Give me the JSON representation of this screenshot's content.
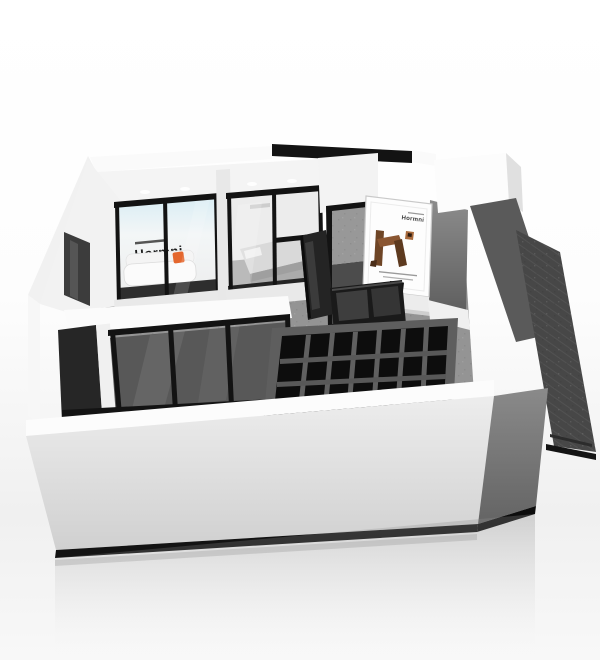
{
  "brand": "Hormni",
  "signs": {
    "sofa_room_wall_sign": "Hormni",
    "poster_logo": "Hormni"
  },
  "icons": {
    "qr_code": "▦"
  },
  "colors": {
    "background": "#ffffff",
    "wall_white": "#f8f8f8",
    "wall_shade": "#e2e2e2",
    "floor_gray": "#949494",
    "glass_dark": "#585858",
    "frame_black": "#131313",
    "dark_gray_wall": "#5a5a5a",
    "ramp_dark": "#474747",
    "front_wall_light": "#ededed",
    "front_wall_dark": "#d0d0d0",
    "accent_orange": "#e4672e",
    "wood_brown": "#6e4526",
    "backlit_blue": "#d9edf4"
  }
}
